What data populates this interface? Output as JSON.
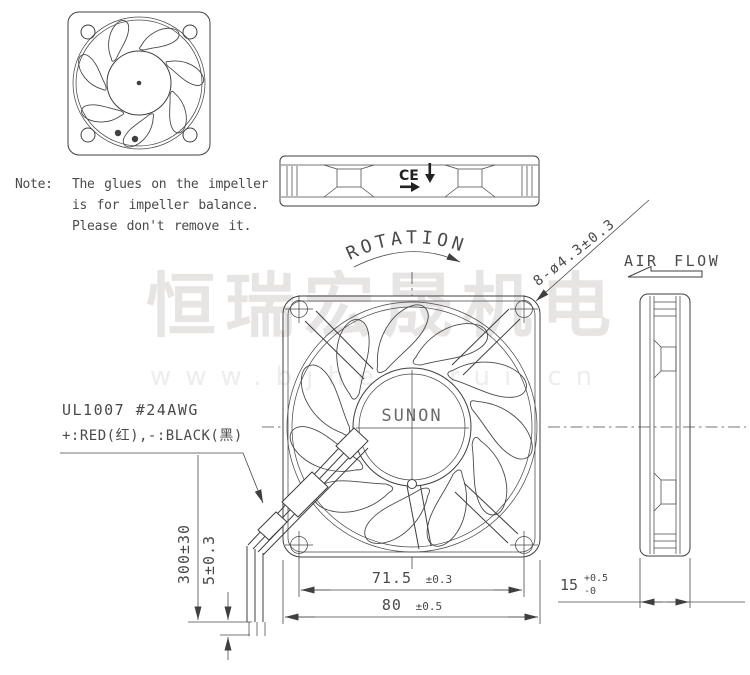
{
  "drawing": {
    "note": {
      "label": "Note:",
      "line1": "The glues on the impeller",
      "line2": "is for impeller balance.",
      "line3": "Please don't remove it."
    },
    "wire_spec": {
      "line1": "UL1007  #24AWG",
      "line2": "+:RED(红),-:BLACK(黑)"
    },
    "labels": {
      "rotation": "ROTATION",
      "air_flow": "AIR FLOW",
      "hub_brand": "SUNON",
      "ce_mark": "CE",
      "mounting_holes": "8-ø4.3±0.3"
    },
    "dimensions": {
      "hole_pitch_value": "71.5",
      "hole_pitch_tol": "±0.3",
      "frame_size_value": "80",
      "frame_size_tol": "±0.5",
      "thickness_value": "15",
      "thickness_tol_plus": "+0.5",
      "thickness_tol_minus": "-0",
      "lead_length": "300±30",
      "strip_length": "5±0.3"
    },
    "watermark": {
      "brand": "恒瑞宏晟机电",
      "url": "www.bjhengrui.cn"
    },
    "colors": {
      "line": "#3f3f3f",
      "text": "#4a4a4a",
      "watermark": "#e7e5e4"
    }
  }
}
